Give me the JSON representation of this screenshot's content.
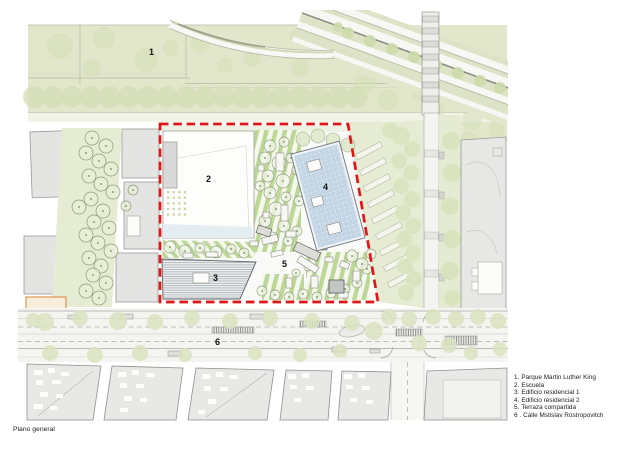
{
  "title": "Plano general",
  "plan": {
    "markers": [
      "1",
      "2",
      "3",
      "4",
      "5",
      "6"
    ]
  },
  "legend": {
    "items": [
      {
        "num": "1.",
        "label": "Parque Martin Luther King"
      },
      {
        "num": "2.",
        "label": "Escuela"
      },
      {
        "num": "3.",
        "label": "Edificio residencial 1"
      },
      {
        "num": "4.",
        "label": "Edificio residencial 2"
      },
      {
        "num": "5.",
        "label": "Terraza compartida"
      },
      {
        "num": "6 .",
        "label": "Calle Mstislav Rostropovitch"
      }
    ]
  },
  "colors": {
    "site_boundary": "#e01515",
    "park_green": "#e2e7cc",
    "stripe_green": "#bdd796",
    "roof_grid_blue": "#c6d8e8",
    "tree_green": "#d4deb6",
    "orange_marker": "#d9822e"
  }
}
